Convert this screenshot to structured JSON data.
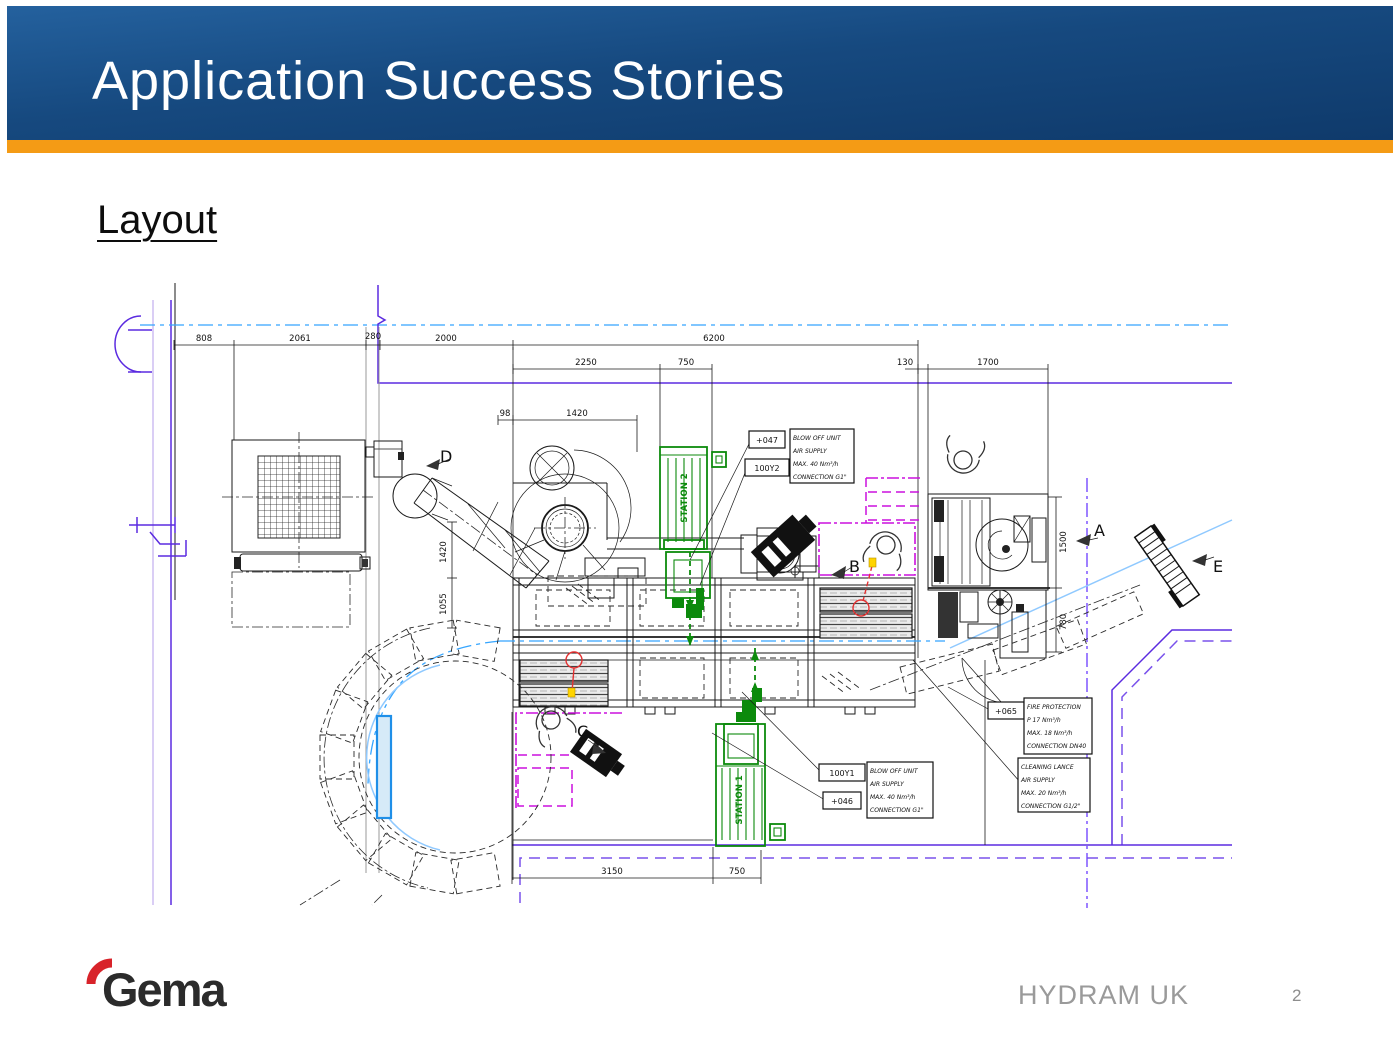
{
  "slide": {
    "title": "Application Success Stories",
    "heading": "Layout",
    "footer": "HYDRAM UK",
    "page_number": "2",
    "logo_text": "Gema"
  },
  "colors": {
    "header_blue_top": "#24619e",
    "header_blue_bottom": "#0f3a6b",
    "accent_orange": "#f49b15",
    "cad_purple": "#5b2be0",
    "cad_centerline_blue": "#35a5ff",
    "cad_magenta": "#cc10dd",
    "cad_green": "#0c8a0c",
    "logo_red": "#d8232a",
    "footer_gray": "#9a9a9a"
  },
  "drawing": {
    "dimensions": {
      "top1_a": "808",
      "top1_b": "2061",
      "top1_c": "280",
      "top1_d": "2000",
      "top1_e": "6200",
      "top2_a": "2250",
      "top2_b": "750",
      "top2_c": "130",
      "top2_d": "1700",
      "top3_a": "98",
      "top3_b": "1420",
      "left_a": "1420",
      "left_b": "1055",
      "right_a": "1500",
      "right_b": "780",
      "bottom_a": "3150",
      "bottom_b": "750"
    },
    "view_labels": {
      "a": "A",
      "b": "B",
      "c": "C",
      "d": "D",
      "e": "E"
    },
    "stations": {
      "station1": "STATION 1",
      "station2": "STATION 2"
    },
    "callouts": {
      "blow_off_top": {
        "tag1": "+047",
        "tag2": "100Y2",
        "line1": "BLOW OFF UNIT",
        "line2": "AIR SUPPLY",
        "line3": "MAX. 40 Nm³/h",
        "line4": "CONNECTION G1\""
      },
      "blow_off_bottom": {
        "tag1": "100Y1",
        "tag2": "+046",
        "line1": "BLOW OFF UNIT",
        "line2": "AIR SUPPLY",
        "line3": "MAX. 40 Nm³/h",
        "line4": "CONNECTION G1\""
      },
      "fire_protection": {
        "tag": "+065",
        "line1": "FIRE PROTECTION",
        "line2": "P  17 Nm³/h",
        "line3": "MAX. 18 Nm³/h",
        "line4": "CONNECTION DN40"
      },
      "cleaning_lance": {
        "line1": "CLEANING LANCE",
        "line2": "AIR SUPPLY",
        "line3": "MAX. 20 Nm³/h",
        "line4": "CONNECTION G1/2\""
      }
    }
  }
}
